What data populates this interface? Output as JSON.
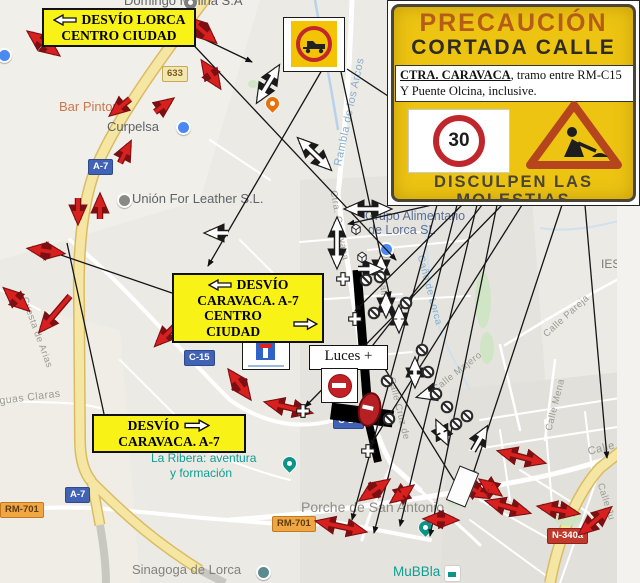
{
  "banner": {
    "title": "PRECAUCIÓN",
    "subtitle": "CORTADA CALLE",
    "detail_main": "CTRA. CARAVACA",
    "detail_rest": ", tramo entre RM-C15",
    "detail_line2": "Y Puente Olcina, inclusive.",
    "speed_limit": "30",
    "apology1": "DISCULPEN LAS",
    "apology2": "MOLESTIAS"
  },
  "labels": {
    "lorca": {
      "l1": "DESVÍO LORCA",
      "l2": "CENTRO CIUDAD"
    },
    "caravaca_centro": {
      "l1": "DESVÍO",
      "l2": "CARAVACA. A-7",
      "l3": "CENTRO CIUDAD"
    },
    "caravaca": {
      "l1": "DESVÍO",
      "l2": "CARAVACA. A-7"
    },
    "luces": "Luces +"
  },
  "badges": [
    {
      "text": "633"
    },
    {
      "text": "A-7"
    },
    {
      "text": "C-15"
    },
    {
      "text": "C-15"
    },
    {
      "text": "A-7"
    },
    {
      "text": "RM-701"
    },
    {
      "text": "RM-701"
    },
    {
      "text": "N-340a"
    }
  ],
  "places": [
    {
      "name": "Domingo Molina S.A"
    },
    {
      "name": "Bar Pintor"
    },
    {
      "name": "Curpelsa"
    },
    {
      "name": "Unión For Leather S.L."
    },
    {
      "name": "Grupo Alimentario"
    },
    {
      "name": "de Lorca SL"
    },
    {
      "name": "La Ribera: aventura"
    },
    {
      "name": "y formación"
    },
    {
      "name": "Porche de San Antonio"
    },
    {
      "name": "Sinagoga de Lorca"
    },
    {
      "name": "MuBBla"
    },
    {
      "name": "IES"
    }
  ],
  "streets": [
    {
      "name": "Rambla de los Arcos"
    },
    {
      "name": "Ctra. Caravaca"
    },
    {
      "name": "Caño de Lorca"
    },
    {
      "name": "Calle Po"
    },
    {
      "name": "Calle Cruz de"
    },
    {
      "name": "Calle Majero"
    },
    {
      "name": "Calle Pareja"
    },
    {
      "name": "Calle Mena"
    },
    {
      "name": "Cuesta de Arias"
    },
    {
      "name": "Aguas Claras"
    },
    {
      "name": "Calle"
    },
    {
      "name": "Calle Ju"
    }
  ],
  "colors": {
    "sign_yellow": "#edc412",
    "label_yellow": "#f8f216",
    "arrow_red": "#d8201f",
    "highway_yellow": "#f3dc8a",
    "teal_poi": "#0f9d93"
  }
}
